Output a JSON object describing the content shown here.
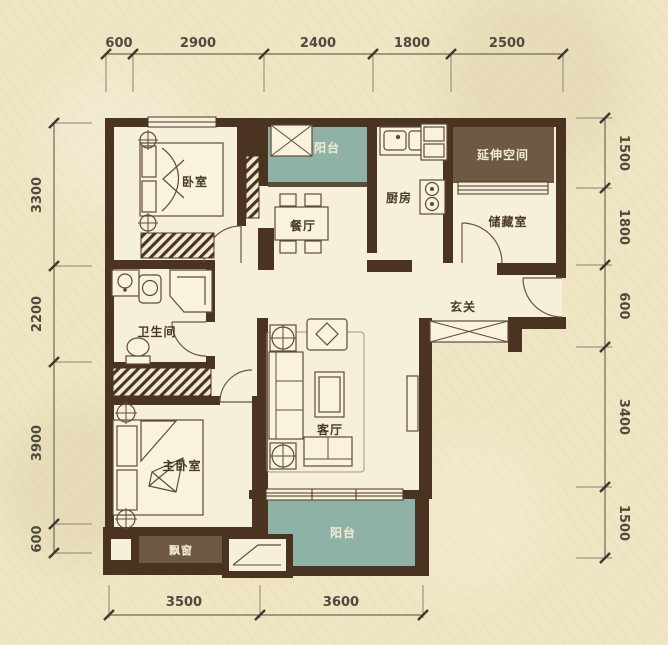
{
  "plan": {
    "rooms": {
      "bedroom": "卧室",
      "balcony_top": "阳台",
      "kitchen": "厨房",
      "extension": "延伸空间",
      "storage": "储藏室",
      "dining": "餐厅",
      "entry": "玄关",
      "bathroom": "卫生间",
      "master_bedroom": "主卧室",
      "living": "客厅",
      "balcony_bottom": "阳台",
      "bay_window": "飘窗"
    },
    "dimensions": {
      "top": [
        "600",
        "2900",
        "2400",
        "1800",
        "2500"
      ],
      "left": [
        "3300",
        "2200",
        "3900",
        "600"
      ],
      "right": [
        "1500",
        "1800",
        "600",
        "3400",
        "1500"
      ],
      "bottom": [
        "3500",
        "3600"
      ]
    },
    "colors": {
      "background": "#efe5c3",
      "floor": "#f6f0da",
      "wall": "#4b3322",
      "balcony_teal": "#8eb2a5",
      "feature_brown": "#6e5a43",
      "dim_text": "#4f4a3e"
    }
  }
}
